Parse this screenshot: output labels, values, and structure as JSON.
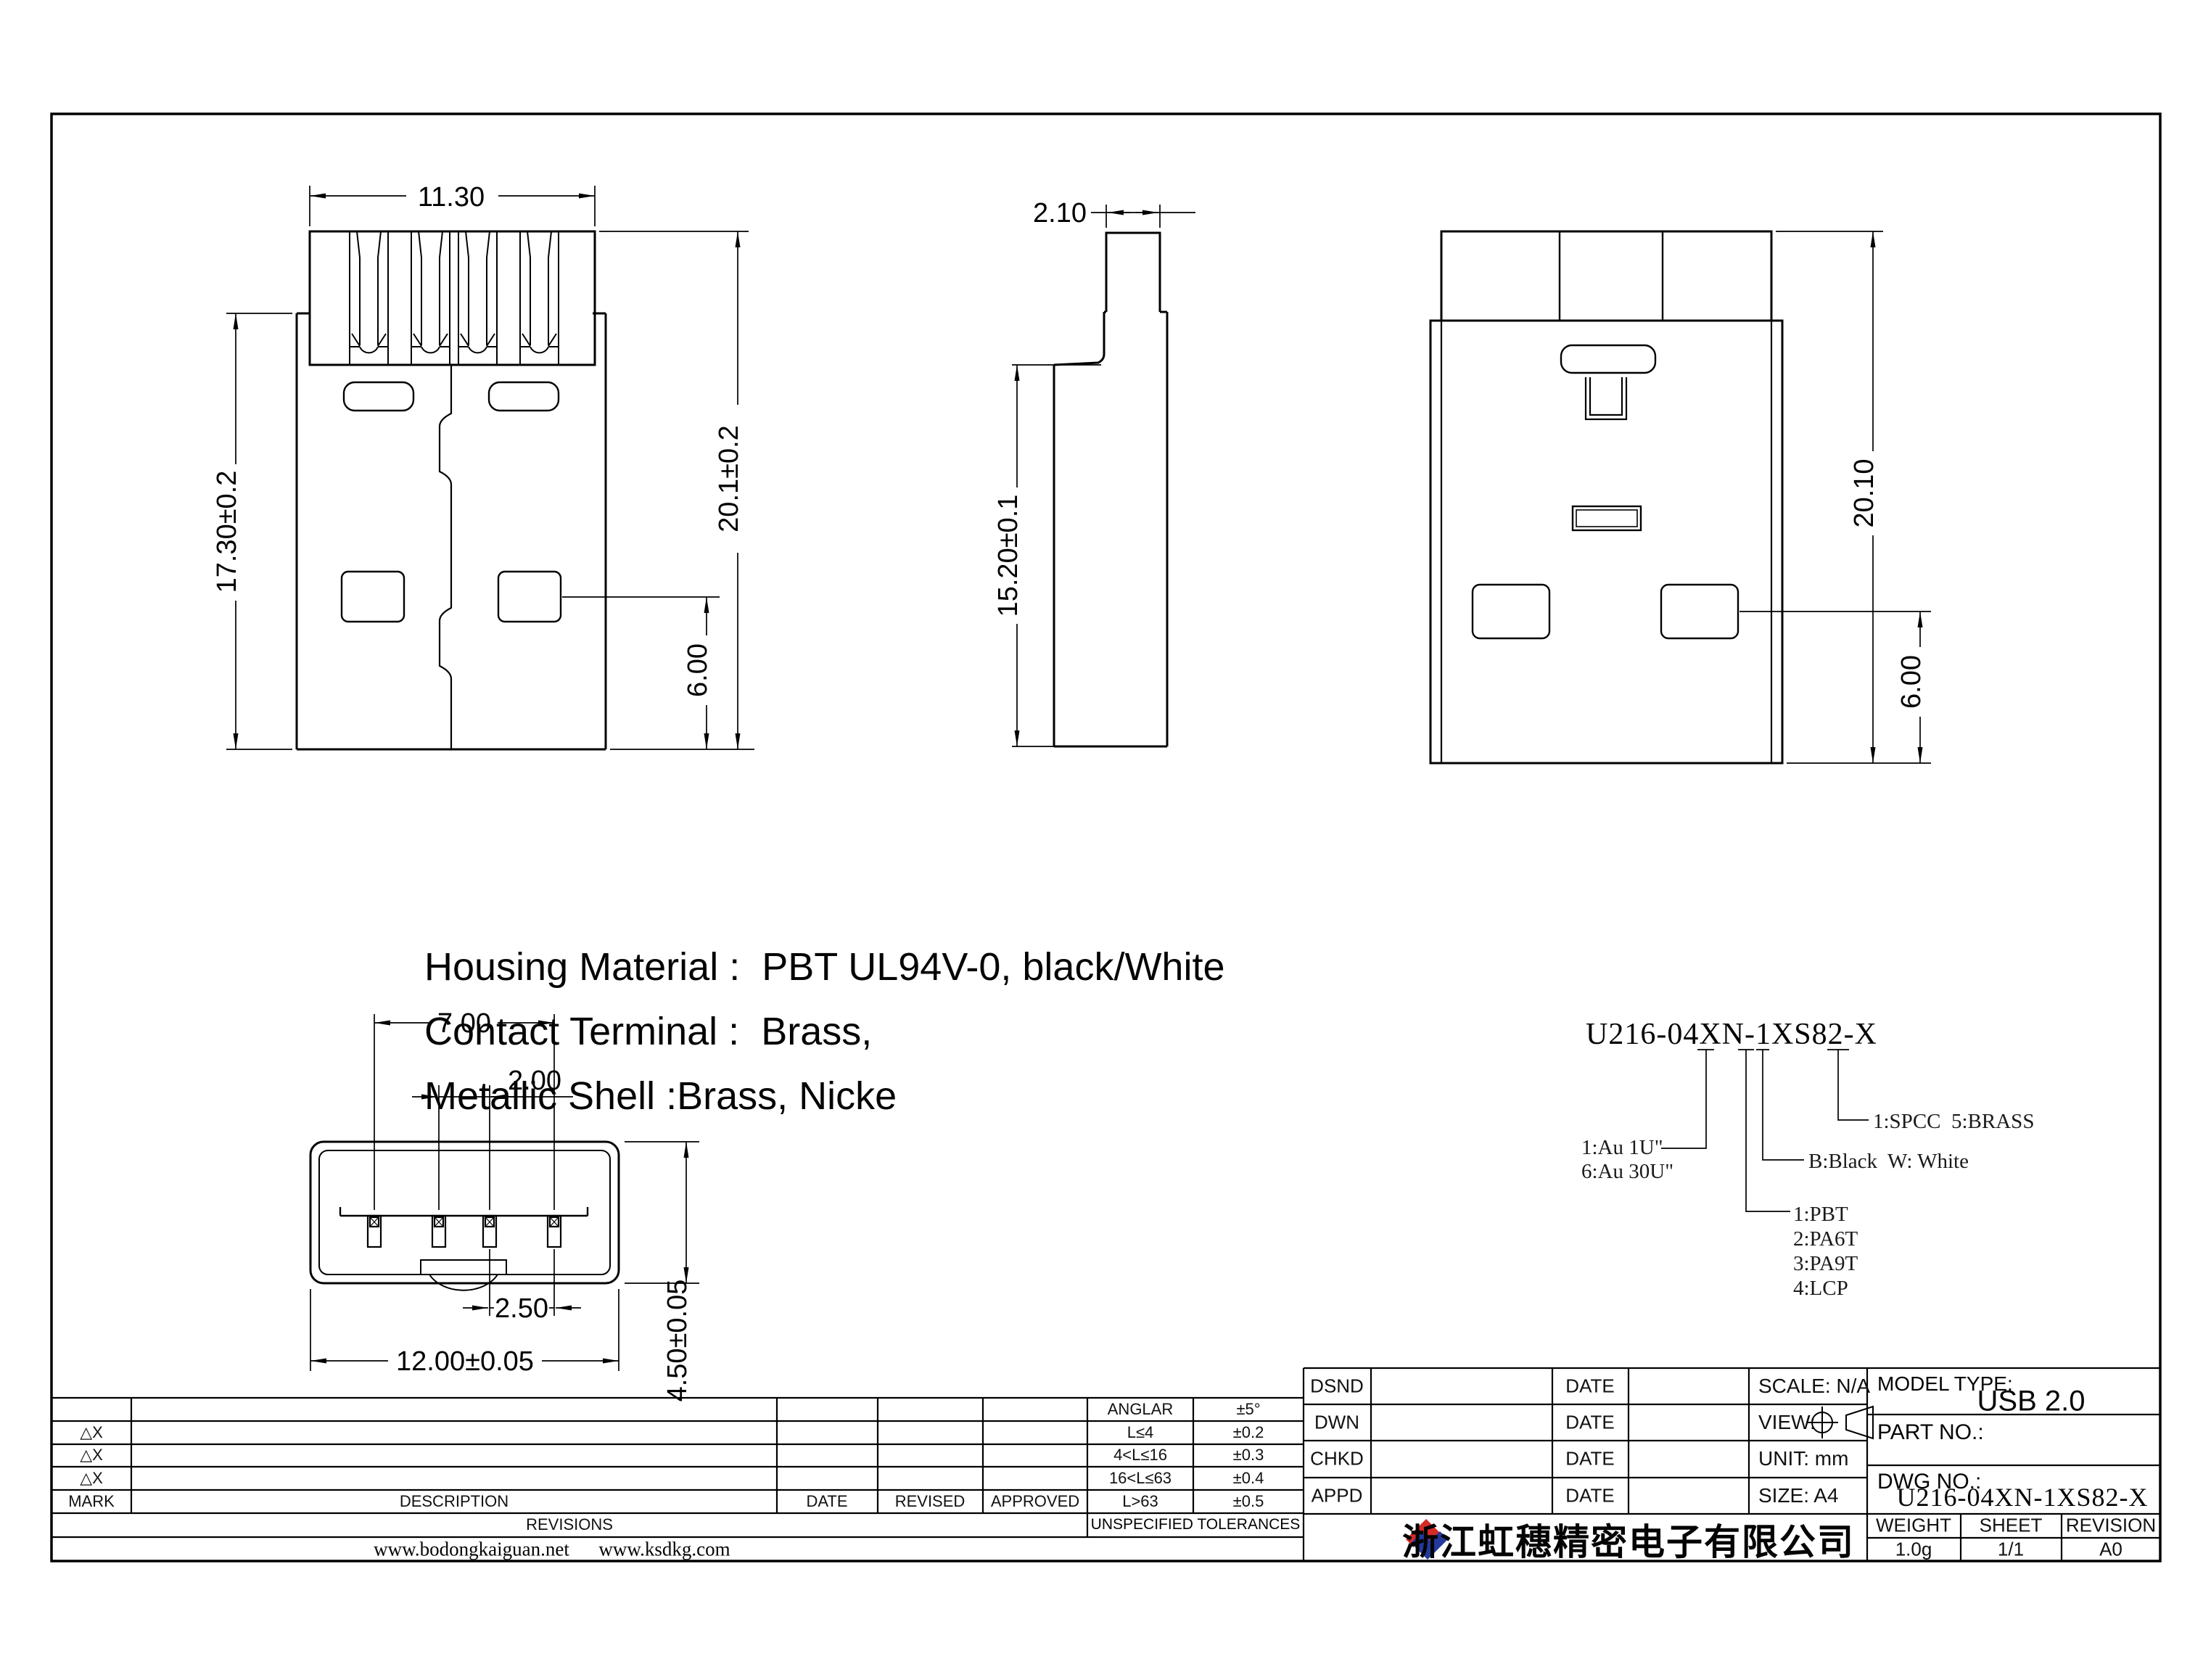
{
  "views": {
    "front": {
      "width": "11.30",
      "height_left": "17.30±0.2",
      "height_right": "20.1±0.2",
      "hole_offset": "6.00"
    },
    "side": {
      "tab_width": "2.10",
      "height": "15.20±0.1"
    },
    "back": {
      "height": "20.10",
      "hole_offset": "6.00"
    },
    "bottom": {
      "pin_span": "7.00",
      "pin_pitch": "2.00",
      "pin_pitch_right": "2.50",
      "width": "12.00±0.05",
      "height": "4.50±0.05"
    }
  },
  "notes": {
    "line1": "Housing Material :  PBT UL94V-0, black/White",
    "line2": "Contact Terminal :  Brass,",
    "line3": "Metallic Shell :Brass, Nicke"
  },
  "part_code": {
    "number": "U216-04XN-1XS82-X",
    "plating_line1": "1:Au 1U\"",
    "plating_line2": "6:Au 30U\"",
    "shell_materials": "1:SPCC  5:BRASS",
    "colors": "B:Black  W: White",
    "housing_materials": [
      "1:PBT",
      "2:PA6T",
      "3:PA9T",
      "4:LCP"
    ]
  },
  "revisions": {
    "delta_mark": "△X",
    "headers": {
      "mark": "MARK",
      "description": "DESCRIPTION",
      "date": "DATE",
      "revised": "REVISED",
      "approved": "APPROVED"
    },
    "band_revisions": "REVISIONS",
    "band_unspecified": "UNSPECIFIED TOLERANCES",
    "tol": [
      [
        "ANGLAR",
        "±5°"
      ],
      [
        "L≤4",
        "±0.2"
      ],
      [
        "4<L≤16",
        "±0.3"
      ],
      [
        "16<L≤63",
        "±0.4"
      ],
      [
        "L>63",
        "±0.5"
      ]
    ],
    "website1": "www.bodongkaiguan.net",
    "website2": "www.ksdkg.com"
  },
  "title": {
    "row_labels": [
      "DSND",
      "DWN",
      "CHKD",
      "APPD"
    ],
    "date_label": "DATE",
    "right_cells": [
      "SCALE: N/A",
      "VIEW:",
      "UNIT: mm",
      "SIZE: A4"
    ],
    "model_type_label": "MODEL TYPE:",
    "model_type": "USB 2.0",
    "part_no_label": "PART NO.:",
    "dwg_no_label": "DWG NO.:",
    "dwg_no": "U216-04XN-1XS82-X",
    "weight_label": "WEIGHT",
    "weight": "1.0g",
    "sheet_label": "SHEET",
    "sheet": "1/1",
    "revision_label": "REVISION",
    "revision": "A0",
    "company": "浙江虹穗精密电子有限公司"
  },
  "colors": {
    "logo_red": "#d42b26",
    "logo_blue": "#23399c",
    "line": "#000000"
  }
}
